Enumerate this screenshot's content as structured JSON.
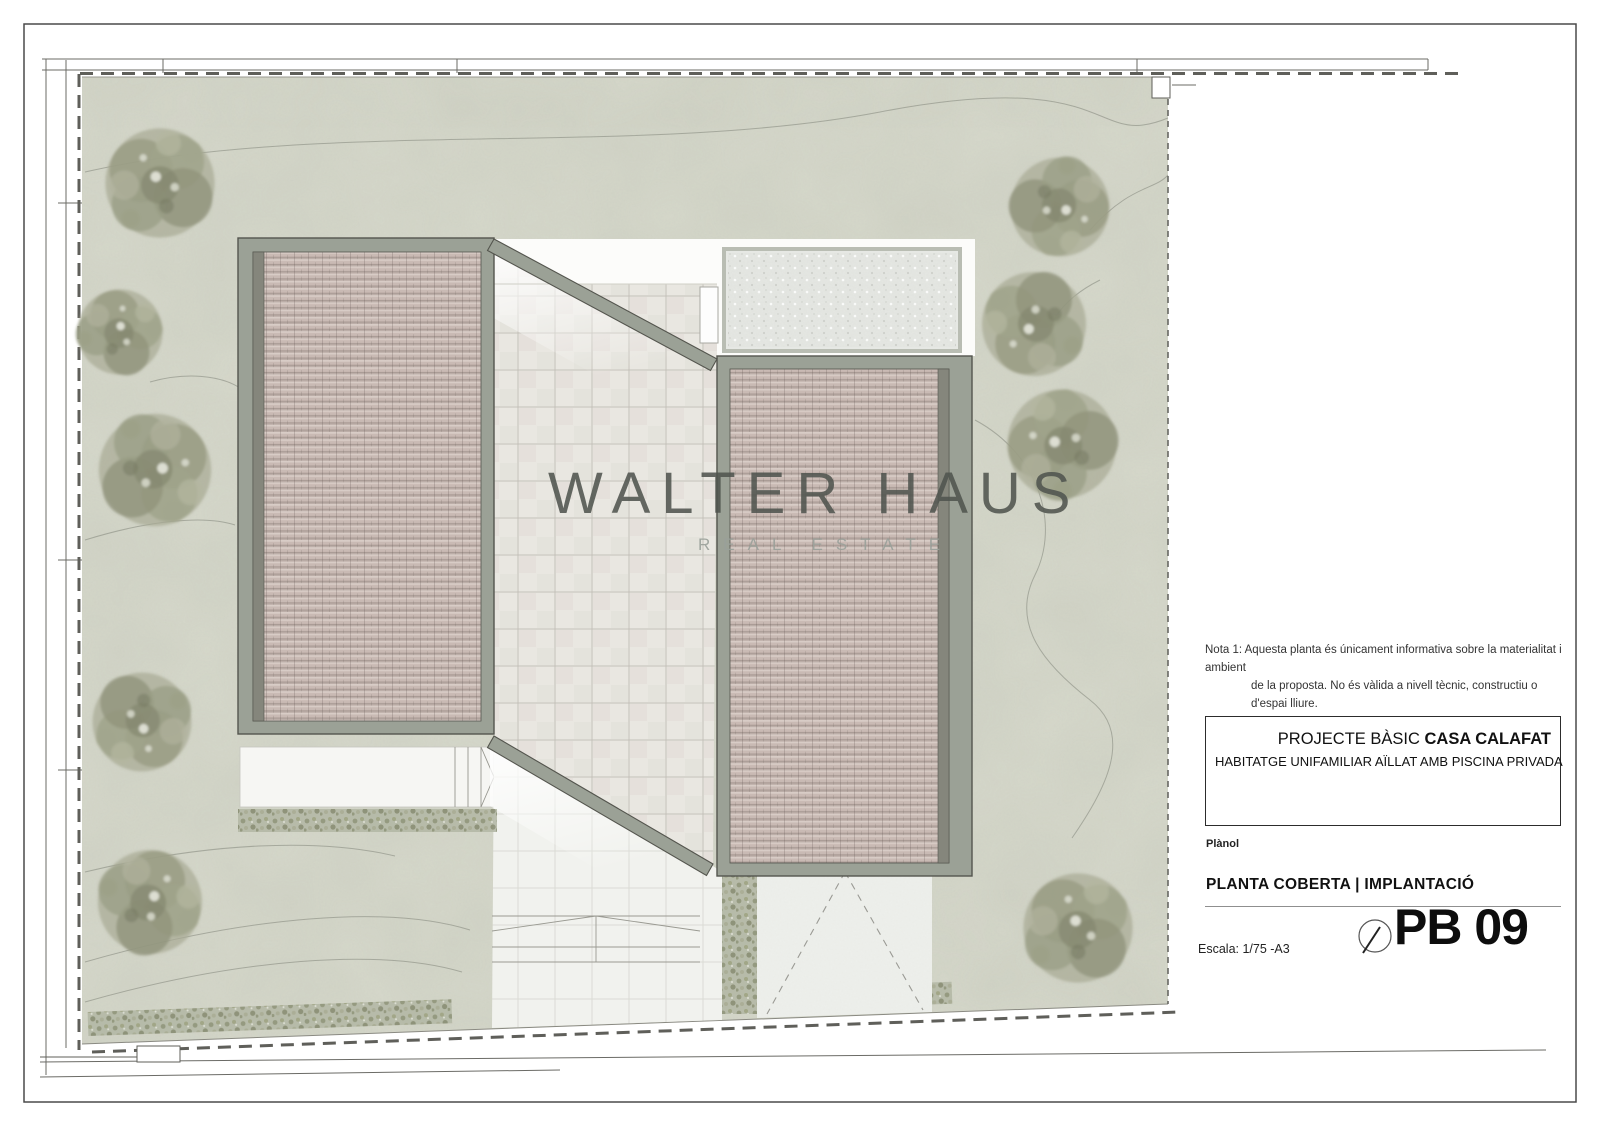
{
  "watermark": {
    "brand": "WALTER HAUS",
    "tagline": "REAL ESTATE"
  },
  "note": {
    "line1": "Nota 1: Aquesta planta és únicament  informativa sobre la materialitat i ambient",
    "line2": "de la proposta. No és vàlida a nivell tècnic, constructiu o d'espai lliure."
  },
  "title_block": {
    "project_prefix": "PROJECTE BÀSIC ",
    "project_name": "CASA CALAFAT",
    "subtitle": "HABITATGE UNIFAMILIAR AÏLLAT AMB PISCINA PRIVADA",
    "plan_label": "Plànol",
    "plan_title": "PLANTA COBERTA | IMPLANTACIÓ",
    "scale": "Escala: 1/75  -A3",
    "sheet_code": "PB 09"
  },
  "colors": {
    "terrain": "#d7d9cc",
    "roof_tile": "#c9bab4",
    "roof_frame": "#9ba196",
    "terrace_tile": "#e9e7e1",
    "hedge": "#b7bba9",
    "line_dark": "#54554e"
  }
}
